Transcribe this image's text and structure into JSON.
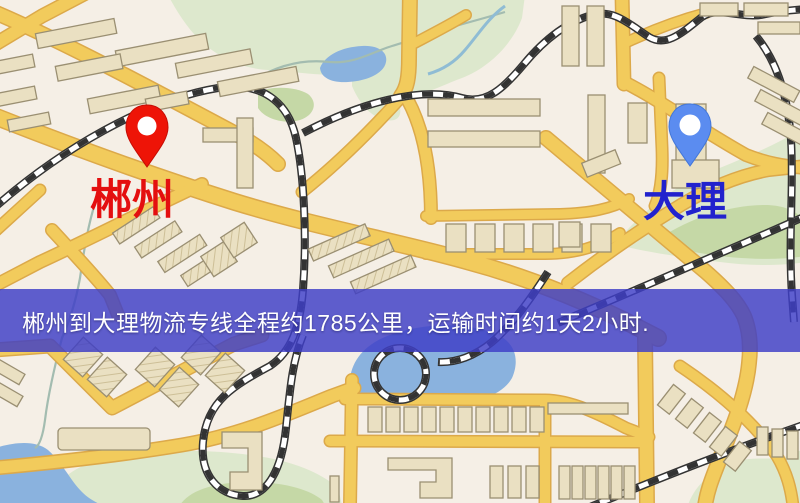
{
  "banner": {
    "text": "郴州到大理物流专线全程约1785公里，运输时间约1天2小时.",
    "bg_color": "rgba(62,62,198,0.83)",
    "text_color": "#ffffff"
  },
  "markers": {
    "origin": {
      "label": "郴州",
      "pin_color": "#ee1407",
      "pin_stroke": "#c50d04",
      "label_color": "#e40f0f"
    },
    "destination": {
      "label": "大理",
      "pin_color": "#5b8cf0",
      "pin_stroke": "#4377d8",
      "label_color": "#2222cd"
    }
  },
  "map": {
    "palette": {
      "background": "#f5efe6",
      "road": "#f2cb5c",
      "road_casing": "#dca94a",
      "building": "#eae0c2",
      "park": "#dde8cd",
      "park_dark": "#c5d8a6",
      "water": "#8ab2de",
      "railway": "#2f2f2f"
    }
  }
}
